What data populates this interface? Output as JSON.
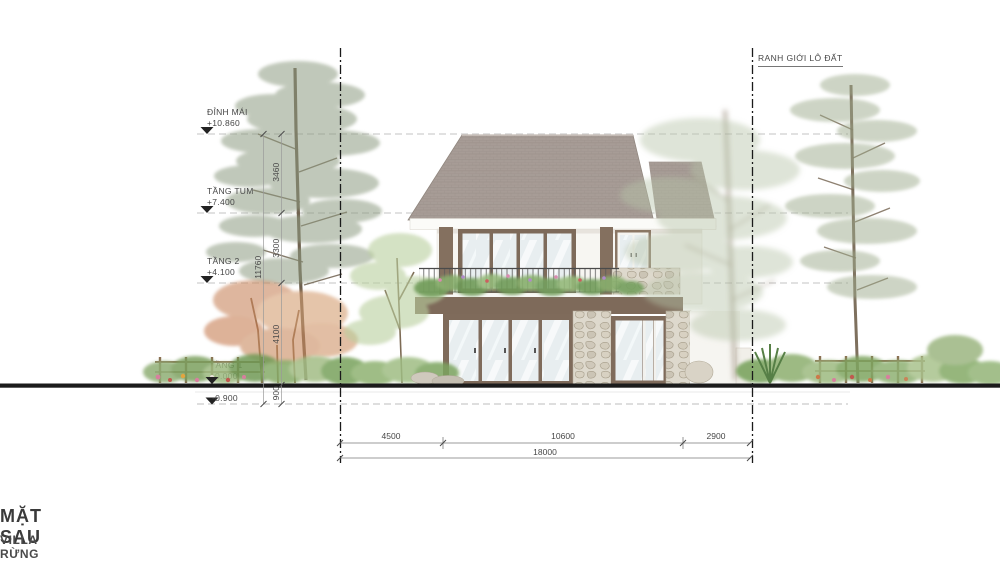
{
  "drawing": {
    "title": "MẶT SAU",
    "subtitle": "VILLA RỪNG - ĐƠN LẬP 18X22"
  },
  "boundary": {
    "left": "RANH GIỚI LÔ ĐẤT",
    "right": "RANH GIỚI LÔ ĐẤT"
  },
  "levels": [
    {
      "name": "ĐỈNH MÁI",
      "elevation": "+10.860"
    },
    {
      "name": "TẦNG TUM",
      "elevation": "+7.400"
    },
    {
      "name": "TẦNG 2",
      "elevation": "+4.100"
    },
    {
      "name": "TẦNG 1",
      "elevation": "±0.000"
    },
    {
      "name": "",
      "elevation": "-0.900"
    }
  ],
  "dimensions": {
    "vertical_segments": [
      "3460",
      "3300",
      "4100",
      "900"
    ],
    "vertical_total": "11760",
    "horizontal_segments": [
      "4500",
      "10600",
      "2900"
    ],
    "horizontal_total": "18000"
  },
  "colors": {
    "roof": "#a79c96",
    "wood_frame": "#7f6b5b",
    "stone": "#ded9cd",
    "glass": "#e8eef0",
    "wall": "#f7f6f2",
    "ground_line": "#1b1b1b",
    "foliage_muted_green": "#8e9c84",
    "foliage_autumn_orange": "#c9875f"
  }
}
